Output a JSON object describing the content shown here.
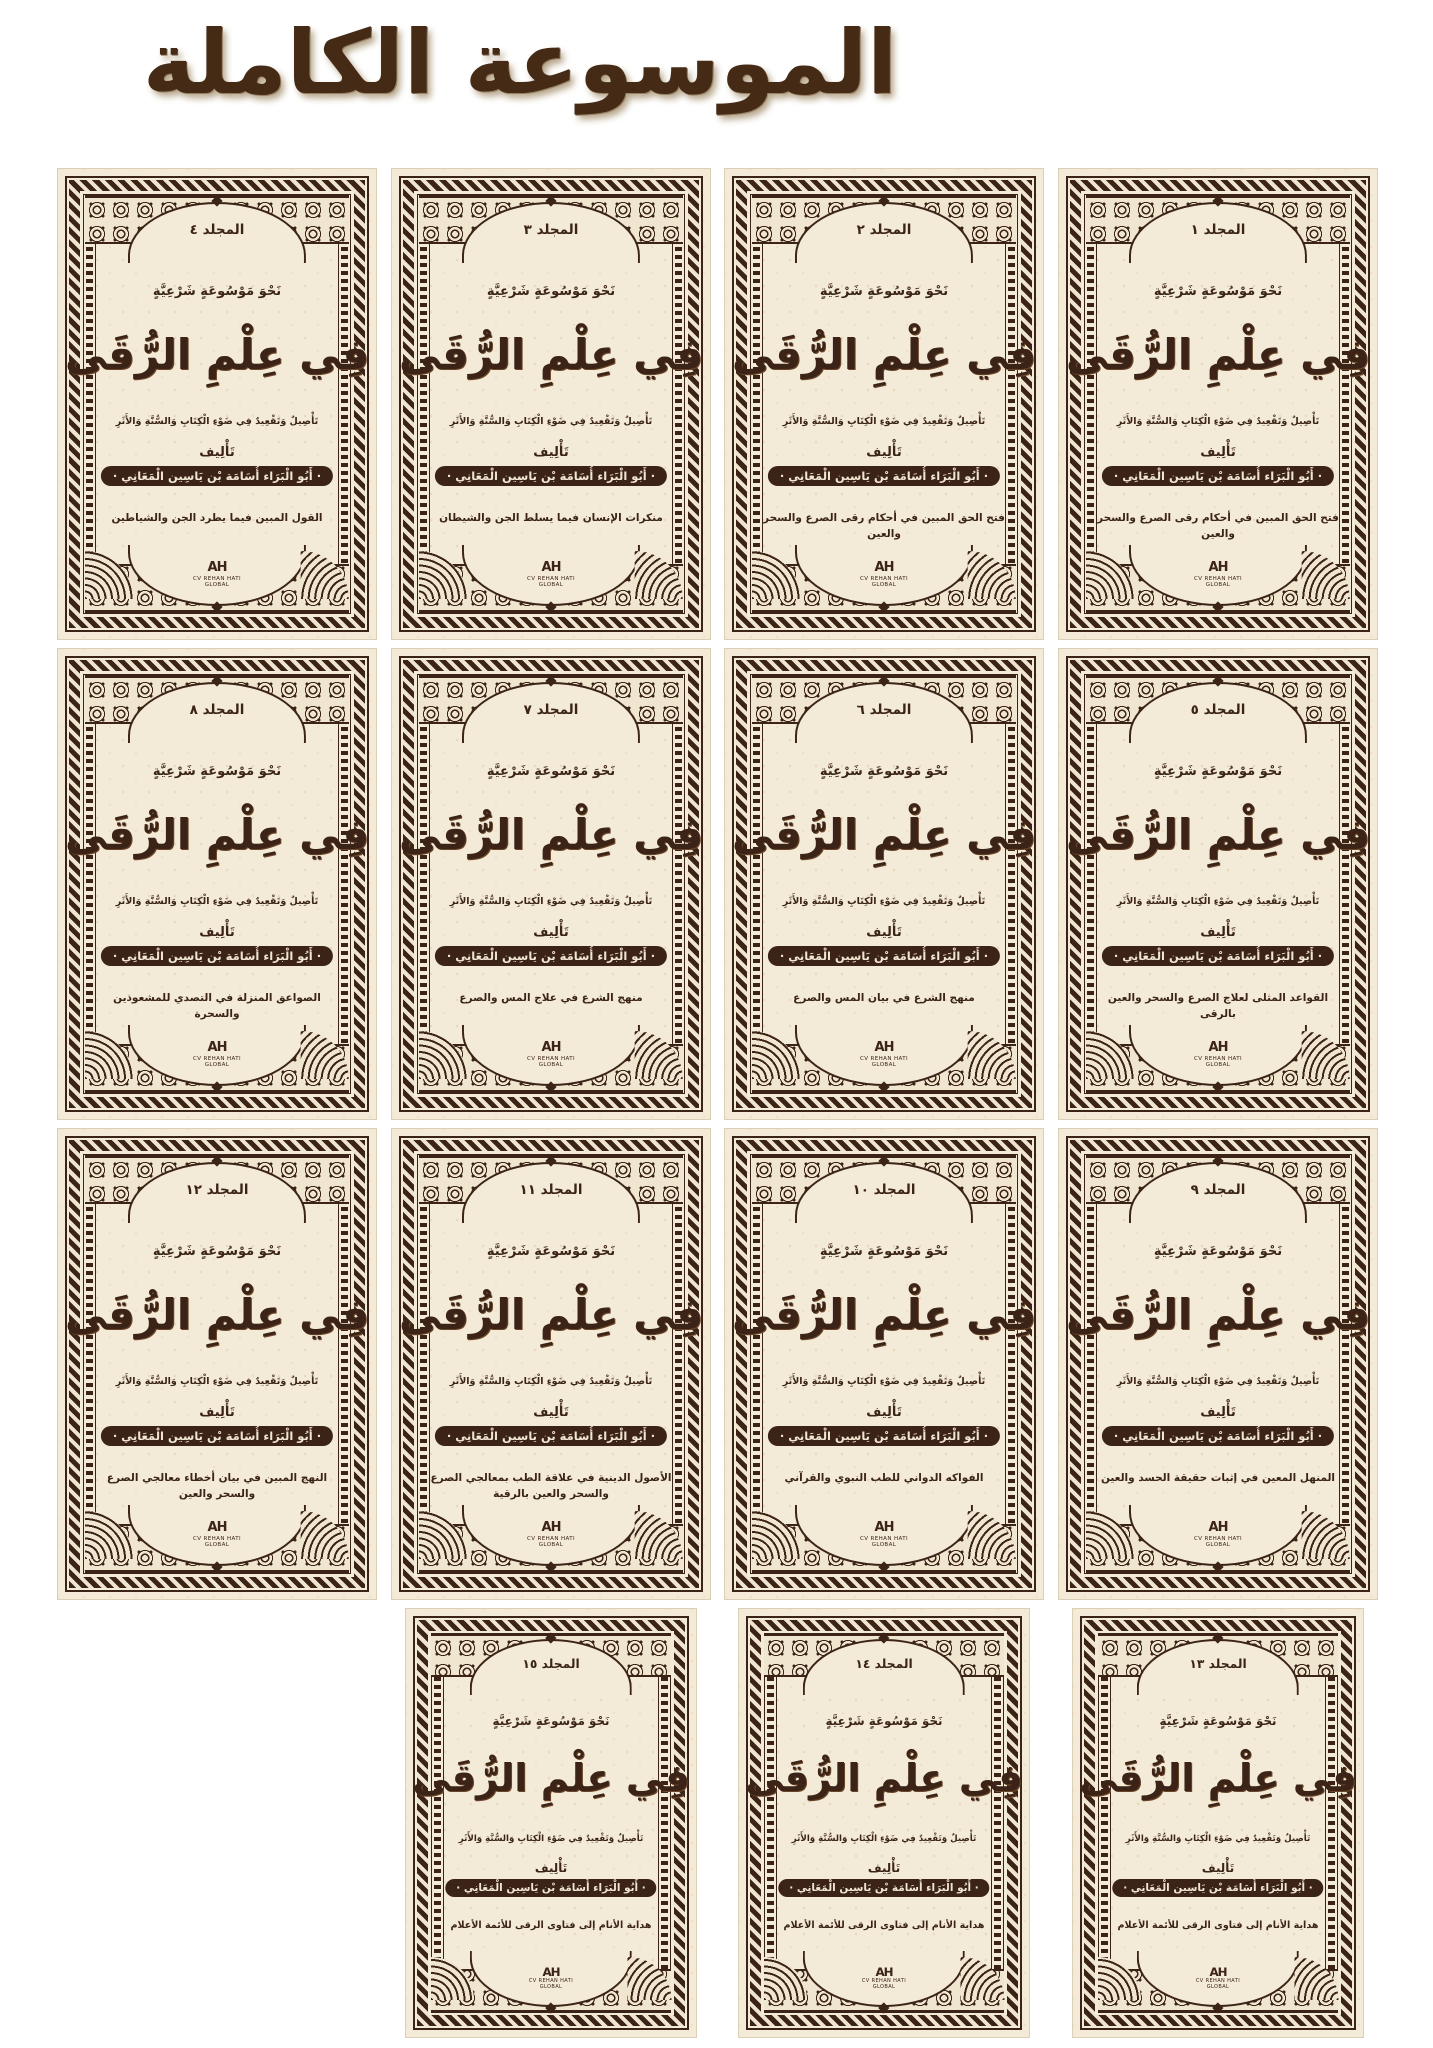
{
  "header": {
    "title": "الموسوعة الكاملة"
  },
  "colors": {
    "ink": "#3b2417",
    "paper": "#f4ead8",
    "page_background": "#ffffff"
  },
  "grid": {
    "rows": [
      4,
      4,
      4,
      3
    ]
  },
  "cover_common": {
    "series_line": "نَحْوَ مَوْسُوعَةٍ شَرْعِيَّةٍ",
    "main_title": "فِي عِلْمِ الرُّقَى",
    "subtitle": "تَأْصِيلٌ وَتَقْعِيدٌ فِي ضَوْءِ الْكِتَابِ وَالسُّنَّةِ وَالأَثَرِ",
    "byline_label": "تَأْلِيف",
    "author": "· أَبُو الْبَرَاء أُسَامَة بْن يَاسِين الْمَعَانِي ·",
    "publisher_monogram": "AH",
    "publisher_line1": "CV REHAN HATI",
    "publisher_line2": "GLOBAL"
  },
  "volumes": [
    {
      "label": "المجلد ٤",
      "tagline": "القول المبين فيما يطرد الجن والشياطين"
    },
    {
      "label": "المجلد ٣",
      "tagline": "منكرات الإنسان فيما يسلط الجن والشيطان"
    },
    {
      "label": "المجلد ٢",
      "tagline": "فتح الحق المبين في أحكام رقى الصرع والسحر والعين"
    },
    {
      "label": "المجلد ١",
      "tagline": "فتح الحق المبين في أحكام رقى الصرع والسحر والعين"
    },
    {
      "label": "المجلد ٨",
      "tagline": "الصواعق المنزلة في التصدي للمشعوذين والسحرة"
    },
    {
      "label": "المجلد ٧",
      "tagline": "منهج الشرع في علاج المس والصرع"
    },
    {
      "label": "المجلد ٦",
      "tagline": "منهج الشرع في بيان المس والصرع"
    },
    {
      "label": "المجلد ٥",
      "tagline": "القواعد المثلى لعلاج الصرع والسحر والعين بالرقى"
    },
    {
      "label": "المجلد ١٢",
      "tagline": "النهج المبين في بيان أخطاء معالجي الصرع والسحر والعين"
    },
    {
      "label": "المجلد ١١",
      "tagline": "الأصول الدينية في علاقة الطب بمعالجي الصرع والسحر والعين بالرقية"
    },
    {
      "label": "المجلد ١٠",
      "tagline": "الفواكه الدواني للطب النبوي والقرآني"
    },
    {
      "label": "المجلد ٩",
      "tagline": "المنهل المعين في إثبات حقيقة الحسد والعين"
    },
    {
      "label": "المجلد ١٥",
      "tagline": "هداية الأنام إلى فتاوى الرقى للأئمة الأعلام"
    },
    {
      "label": "المجلد ١٤",
      "tagline": "هداية الأنام إلى فتاوى الرقى للأئمة الأعلام"
    },
    {
      "label": "المجلد ١٣",
      "tagline": "هداية الأنام إلى فتاوى الرقى للأئمة الأعلام"
    }
  ]
}
